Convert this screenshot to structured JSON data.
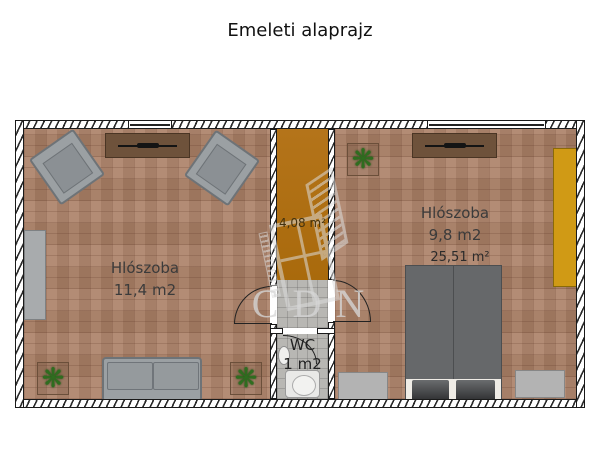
{
  "title": "Emeleti alaprajz",
  "watermark": {
    "text": "CDN"
  },
  "left_room": {
    "name": "Hlószoba",
    "area": "11,4 m2"
  },
  "right_room": {
    "name": "Hlószoba",
    "area": "9,8 m2",
    "total_area": "25,51 m²"
  },
  "stairs": {
    "area": "4,08 m²"
  },
  "wc": {
    "name": "WC",
    "area": "1 m2"
  },
  "colors": {
    "floor_brick": "#ab8066",
    "floor_tile": "#b8b7b3",
    "stairs": "#b06f10",
    "wardrobe_orange": "#d09a15",
    "cabinet_brown": "#6e523b",
    "furniture_gray": "#9ba0a3",
    "bed_gray": "#66686a",
    "plant_green": "#2f6d1f",
    "wall_line": "#1a1a1a"
  }
}
